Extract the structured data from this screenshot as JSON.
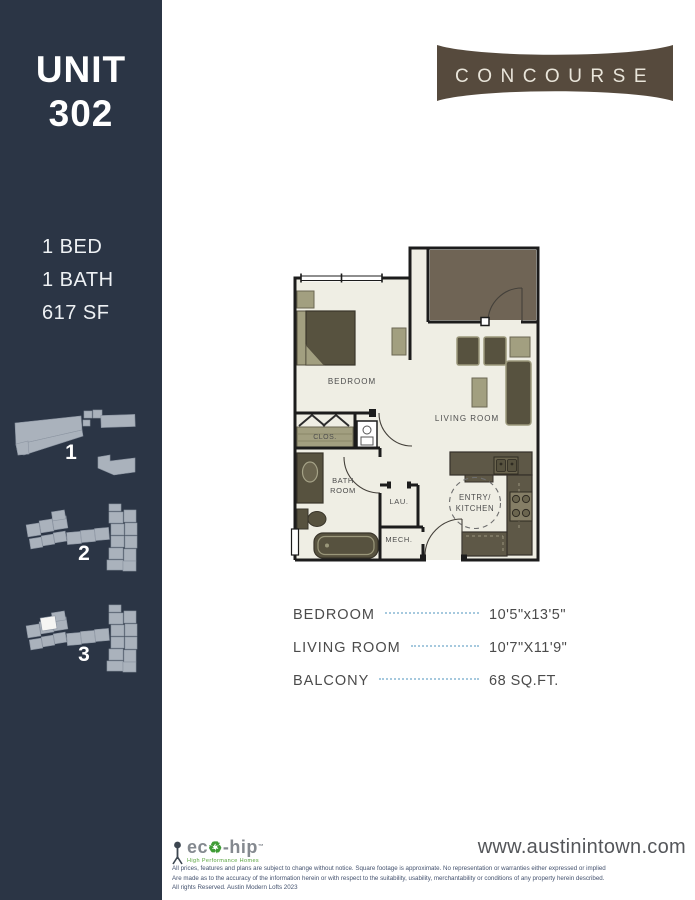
{
  "sidebar": {
    "bg_color": "#2b3545",
    "unit_word": "UNIT",
    "unit_number": "302",
    "specs": [
      "1 BED",
      "1 BATH",
      "617 SF"
    ],
    "buildings": [
      {
        "label": "1",
        "highlighted": false
      },
      {
        "label": "2",
        "highlighted": false
      },
      {
        "label": "3",
        "highlighted": true
      }
    ]
  },
  "brand": {
    "name": "CONCOURSE",
    "bg_color": "#564a3d",
    "text_color": "#e9e5da"
  },
  "floorplan": {
    "labels": {
      "bedroom": "BEDROOM",
      "living": "LIVING ROOM",
      "closet": "CLOS.",
      "bath_line1": "BATH",
      "bath_line2": "ROOM",
      "laundry": "LAU.",
      "mech": "MECH.",
      "entry_line1": "ENTRY/",
      "entry_line2": "KITCHEN"
    },
    "colors": {
      "floor": "#efeee4",
      "walls": "#1c1c1c",
      "balcony_fill": "#6f6455",
      "furniture_dark": "#57523f",
      "furniture_light": "#a29f80",
      "counter": "#5e5847"
    }
  },
  "dimensions": {
    "rows": [
      {
        "room": "BEDROOM",
        "value": "10'5\"x13'5\""
      },
      {
        "room": "LIVING ROOM",
        "value": "10'7\"X11'9\""
      },
      {
        "room": "BALCONY",
        "value": "68 SQ.FT."
      }
    ],
    "leader_color": "#a6c9de"
  },
  "footer": {
    "eco": {
      "left": "ec",
      "recycle_symbol": "♻",
      "right": "-hip",
      "tm": "™",
      "tagline": "High Performance Homes"
    },
    "url": "www.austinintown.com",
    "disclaimer": [
      "All prices, features and plans are subject to change without notice. Square footage is approximate. No representation or warranties either expressed or implied",
      "Are made as to the accuracy of the information herein or with respect to the suitability, usability, merchantability or conditions of any property herein described.",
      "All rights Reserved. Austin Modern Lofts 2023"
    ]
  }
}
